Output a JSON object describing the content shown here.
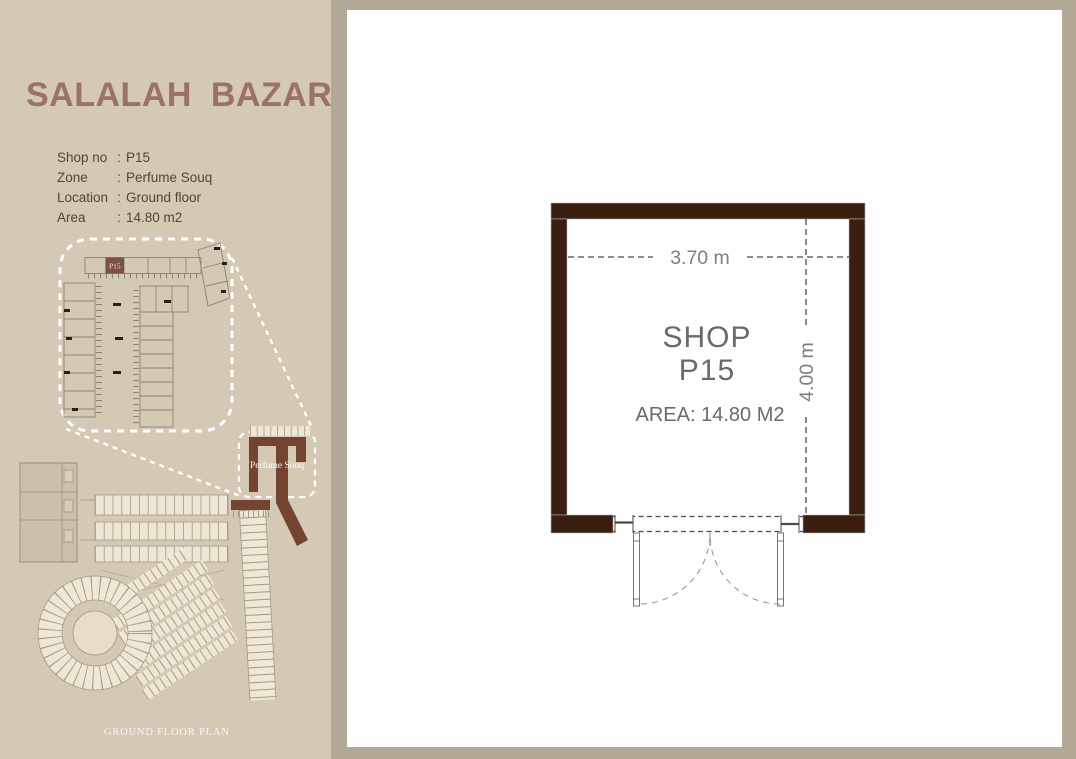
{
  "colors": {
    "page_bg": "#b1a896",
    "sidebar_bg": "#d3c9b5",
    "panel_bg": "#fefefe",
    "title_color": "#9b7265",
    "detail_text_color": "#5a4333",
    "wall_color": "#3a1e0f",
    "plan_text_color": "#6a6a6a",
    "p15_highlight_color": "#7b5043",
    "perfume_souq_color": "#744331"
  },
  "sidebar": {
    "title": "SALALAH BAZAR",
    "details": [
      {
        "label": "Shop no",
        "separator": ":",
        "value": "P15"
      },
      {
        "label": "Zone",
        "separator": ":",
        "value": "Perfume Souq"
      },
      {
        "label": "Location",
        "separator": ":",
        "value": "Ground floor"
      },
      {
        "label": "Area",
        "separator": ":",
        "value": "14.80 m2"
      }
    ],
    "callout_highlight_label": "P15",
    "site_zone_label": "Perfume Souq",
    "footer_caption": "GROUND FLOOR PLAN"
  },
  "floor_plan": {
    "shop_title": "SHOP",
    "shop_number": "P15",
    "area_label": "AREA: 14.80 M2",
    "width_label": "3.70 m",
    "height_label": "4.00 m"
  }
}
